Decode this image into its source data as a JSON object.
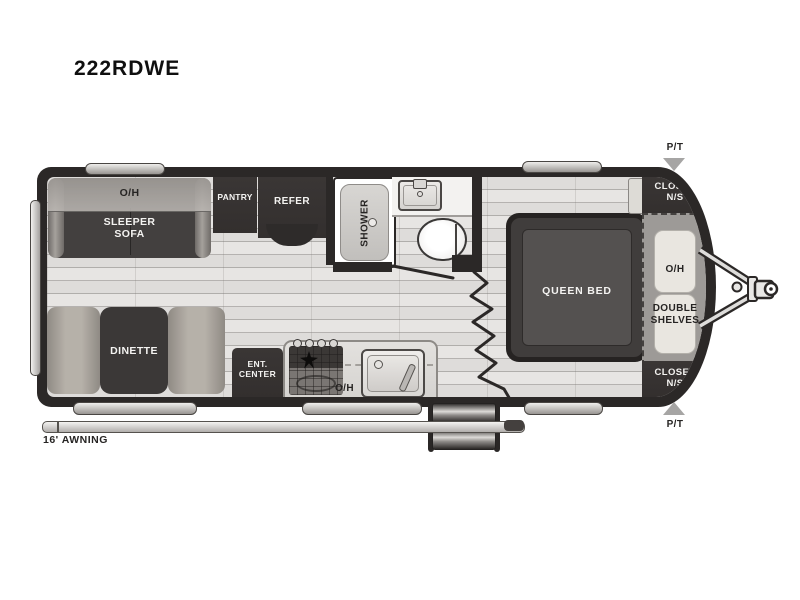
{
  "title": "222RDWE",
  "colors": {
    "wall": "#2b2827",
    "floor": "#e7e5e3",
    "furniture_dark": "#3a3635",
    "bench_beige": "#aba59e",
    "storage_gray": "#9d9a97",
    "cabinet_cream": "#e9e6e0",
    "marker_gray": "#a6a5a4"
  },
  "exterior": {
    "awning_label": "16' AWNING",
    "pt_front_top": "P/T",
    "pt_front_bottom": "P/T"
  },
  "living": {
    "sofa_overhead": "O/H",
    "sofa": "SLEEPER\nSOFA",
    "dinette": "DINETTE"
  },
  "kitchen": {
    "pantry": "PANTRY",
    "refrigerator": "REFER",
    "ent_center": "ENT.\nCENTER",
    "overhead": "O/H"
  },
  "bathroom": {
    "shower": "SHOWER"
  },
  "bedroom": {
    "bed": "QUEEN BED",
    "closet_top": "CLOSET\nN/S",
    "overhead": "O/H",
    "shelves": "DOUBLE\nSHELVES",
    "closet_bottom": "CLOSET\nN/S"
  }
}
